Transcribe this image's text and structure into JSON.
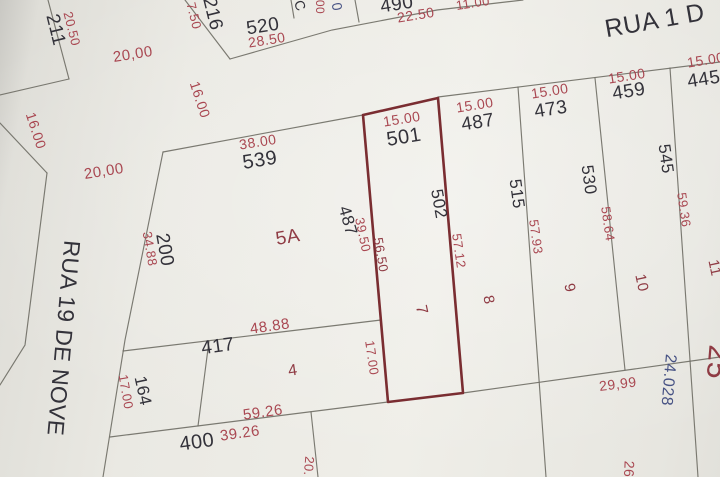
{
  "title": "cadastral plat map photo",
  "palette": {
    "line": "#6e6d64",
    "maroon": "#7a2d31",
    "black": "#33323a",
    "red": "#a94751",
    "lotred": "#8f3b44",
    "navy": "#475284"
  },
  "map": {
    "highlight_parcel": {
      "id": "highlighted-parcel-501-502",
      "points": "363,115 438,98 463,393 388,402",
      "stroke": "maroon",
      "w": 2.6
    },
    "lines": [
      {
        "id": "lot-211-east-boundary",
        "points": "48,0 69,79"
      },
      {
        "id": "lot-211-south-boundary",
        "points": "69,79 0,95"
      },
      {
        "id": "street-corner-boundary",
        "points": "47,173 0,123"
      },
      {
        "id": "rua19-west-edge",
        "points": "47,173 25,345 0,385"
      },
      {
        "id": "block-216-west-boundary",
        "points": "185,0 230,59"
      },
      {
        "id": "block-216-south-boundary",
        "points": "230,59 332,30 437,10 523,0"
      },
      {
        "id": "divider-520-partial-lot",
        "points": "291,0 294,18"
      },
      {
        "id": "divider-partial-lot-490",
        "points": "355,0 359,22"
      },
      {
        "id": "rua1-block-north-boundary",
        "points": "438,97 720,62"
      },
      {
        "id": "block-539-north-boundary",
        "points": "163,152 363,115"
      },
      {
        "id": "block-539-west-boundary",
        "points": "163,152 125,340 103,477"
      },
      {
        "id": "lot-417-north-boundary",
        "points": "123,351 381,320"
      },
      {
        "id": "divider-164-417",
        "points": "209,341 198,426"
      },
      {
        "id": "lot-417-south-boundary",
        "points": "110,437 388,402"
      },
      {
        "id": "lot-400-east-divider",
        "points": "311,412 318,477"
      },
      {
        "id": "diagonal-rear-boundary",
        "points": "463,393 720,357"
      },
      {
        "id": "divider-strip-8-9",
        "points": "518,87 546,477"
      },
      {
        "id": "divider-strip-9-10",
        "points": "595,78 625,370"
      },
      {
        "id": "divider-strip-10-11",
        "points": "670,68 698,477"
      }
    ],
    "labels": [
      {
        "id": "lot-label-211",
        "text": "211",
        "x": 55,
        "y": 30,
        "rot": 76,
        "color": "black",
        "size": 19
      },
      {
        "id": "dim-label-20-50",
        "text": "20.50",
        "x": 71,
        "y": 29,
        "rot": 76,
        "color": "red",
        "size": 13
      },
      {
        "id": "dim-label-16-00-left",
        "text": "16.00",
        "x": 35,
        "y": 131,
        "rot": 72,
        "color": "red",
        "size": 14
      },
      {
        "id": "dim-label-20-00-top",
        "text": "20,00",
        "x": 133,
        "y": 55,
        "rot": -9,
        "color": "red",
        "size": 15
      },
      {
        "id": "dim-label-20-00-mid",
        "text": "20,00",
        "x": 104,
        "y": 172,
        "rot": -9,
        "color": "red",
        "size": 15
      },
      {
        "id": "dim-label-16-00-right",
        "text": "16.00",
        "x": 199,
        "y": 100,
        "rot": 72,
        "color": "red",
        "size": 14
      },
      {
        "id": "dim-label-7-50",
        "text": "7.50",
        "x": 193,
        "y": 16,
        "rot": 76,
        "color": "red",
        "size": 13
      },
      {
        "id": "lot-label-216",
        "text": "216",
        "x": 212,
        "y": 14,
        "rot": 76,
        "color": "black",
        "size": 19
      },
      {
        "id": "lot-label-520",
        "text": "520",
        "x": 263,
        "y": 27,
        "rot": -9,
        "color": "black",
        "size": 19
      },
      {
        "id": "dim-label-28-50",
        "text": "28.50",
        "x": 267,
        "y": 41,
        "rot": -9,
        "color": "red",
        "size": 14
      },
      {
        "id": "partial-label-c",
        "text": "C",
        "x": 299,
        "y": 6,
        "rot": 70,
        "color": "black",
        "size": 14
      },
      {
        "id": "partial-dim-00",
        "text": "00",
        "x": 319,
        "y": 7,
        "rot": 90,
        "color": "red",
        "size": 12
      },
      {
        "id": "partial-label-0",
        "text": "0",
        "x": 336,
        "y": 7,
        "rot": 80,
        "color": "navy",
        "size": 14
      },
      {
        "id": "lot-label-490",
        "text": "490",
        "x": 397,
        "y": 5,
        "rot": -9,
        "color": "black",
        "size": 19
      },
      {
        "id": "dim-label-22-50",
        "text": "22.50",
        "x": 416,
        "y": 16,
        "rot": -9,
        "color": "red",
        "size": 14
      },
      {
        "id": "dim-label-11-00",
        "text": "11.00",
        "x": 473,
        "y": 4,
        "rot": -9,
        "color": "red",
        "size": 13
      },
      {
        "id": "street-label-rua-1",
        "text": "RUA 1 D",
        "x": 655,
        "y": 22,
        "rot": -10,
        "color": "black",
        "size": 25,
        "ls": 6
      },
      {
        "id": "dim-label-15-00-487",
        "text": "15.00",
        "x": 475,
        "y": 106,
        "rot": -9,
        "color": "red",
        "size": 14
      },
      {
        "id": "lot-label-487",
        "text": "487",
        "x": 478,
        "y": 123,
        "rot": -9,
        "color": "black",
        "size": 19
      },
      {
        "id": "dim-label-15-00-473",
        "text": "15.00",
        "x": 550,
        "y": 92,
        "rot": -9,
        "color": "red",
        "size": 14
      },
      {
        "id": "lot-label-473",
        "text": "473",
        "x": 551,
        "y": 110,
        "rot": -9,
        "color": "black",
        "size": 19
      },
      {
        "id": "dim-label-15-00-459",
        "text": "15.00",
        "x": 627,
        "y": 77,
        "rot": -9,
        "color": "red",
        "size": 14
      },
      {
        "id": "lot-label-459",
        "text": "459",
        "x": 629,
        "y": 92,
        "rot": -9,
        "color": "black",
        "size": 19
      },
      {
        "id": "dim-label-15-00-445",
        "text": "15.00",
        "x": 706,
        "y": 61,
        "rot": -9,
        "color": "red",
        "size": 14
      },
      {
        "id": "lot-label-445",
        "text": "445",
        "x": 704,
        "y": 80,
        "rot": -9,
        "color": "black",
        "size": 19
      },
      {
        "id": "dim-label-38-00",
        "text": "38.00",
        "x": 258,
        "y": 143,
        "rot": -9,
        "color": "red",
        "size": 14
      },
      {
        "id": "lot-label-539",
        "text": "539",
        "x": 260,
        "y": 161,
        "rot": -9,
        "color": "black",
        "size": 20
      },
      {
        "id": "dim-label-15-00-501",
        "text": "15.00",
        "x": 402,
        "y": 120,
        "rot": -9,
        "color": "red",
        "size": 14
      },
      {
        "id": "lot-label-501",
        "text": "501",
        "x": 404,
        "y": 138,
        "rot": -9,
        "color": "black",
        "size": 20
      },
      {
        "id": "dim-label-34-88",
        "text": "34.88",
        "x": 149,
        "y": 249,
        "rot": 80,
        "color": "red",
        "size": 13
      },
      {
        "id": "lot-label-200",
        "text": "200",
        "x": 164,
        "y": 250,
        "rot": 80,
        "color": "black",
        "size": 19
      },
      {
        "id": "lot-label-5a",
        "text": "5A",
        "x": 288,
        "y": 238,
        "rot": -10,
        "color": "lotred",
        "size": 19
      },
      {
        "id": "lot-label-487-side",
        "text": "487",
        "x": 347,
        "y": 221,
        "rot": 74,
        "color": "black",
        "size": 17
      },
      {
        "id": "dim-label-39-50",
        "text": "39.50",
        "x": 362,
        "y": 235,
        "rot": 78,
        "color": "red",
        "size": 13
      },
      {
        "id": "dim-label-56-50",
        "text": "56.50",
        "x": 380,
        "y": 255,
        "rot": 80,
        "color": "lotred",
        "size": 13
      },
      {
        "id": "lot-label-502",
        "text": "502",
        "x": 438,
        "y": 204,
        "rot": 80,
        "color": "black",
        "size": 17
      },
      {
        "id": "dim-label-57-12",
        "text": "57.12",
        "x": 458,
        "y": 251,
        "rot": 82,
        "color": "red",
        "size": 13
      },
      {
        "id": "lot-label-515",
        "text": "515",
        "x": 516,
        "y": 194,
        "rot": 82,
        "color": "black",
        "size": 17
      },
      {
        "id": "dim-label-57-93",
        "text": "57.93",
        "x": 535,
        "y": 237,
        "rot": 82,
        "color": "red",
        "size": 13
      },
      {
        "id": "lot-label-530",
        "text": "530",
        "x": 588,
        "y": 180,
        "rot": 82,
        "color": "black",
        "size": 17
      },
      {
        "id": "dim-label-58-64",
        "text": "58.64",
        "x": 607,
        "y": 224,
        "rot": 82,
        "color": "red",
        "size": 13
      },
      {
        "id": "lot-label-545",
        "text": "545",
        "x": 665,
        "y": 159,
        "rot": 82,
        "color": "black",
        "size": 17
      },
      {
        "id": "dim-label-59-36",
        "text": "59.36",
        "x": 683,
        "y": 210,
        "rot": 82,
        "color": "red",
        "size": 13
      },
      {
        "id": "lot-label-7",
        "text": "7",
        "x": 421,
        "y": 310,
        "rot": 78,
        "color": "lotred",
        "size": 16
      },
      {
        "id": "lot-label-8",
        "text": "8",
        "x": 488,
        "y": 300,
        "rot": 78,
        "color": "lotred",
        "size": 15
      },
      {
        "id": "lot-label-9",
        "text": "9",
        "x": 569,
        "y": 288,
        "rot": 78,
        "color": "lotred",
        "size": 15
      },
      {
        "id": "lot-label-10",
        "text": "10",
        "x": 641,
        "y": 283,
        "rot": 78,
        "color": "lotred",
        "size": 15
      },
      {
        "id": "lot-label-11",
        "text": "11",
        "x": 714,
        "y": 268,
        "rot": 78,
        "color": "lotred",
        "size": 15
      },
      {
        "id": "street-label-rua-19",
        "text": "RUA 19 DE NOVE",
        "x": 62,
        "y": 338,
        "rot": 95,
        "color": "black",
        "size": 23,
        "ls": 5
      },
      {
        "id": "dim-label-48-88",
        "text": "48.88",
        "x": 270,
        "y": 327,
        "rot": -8,
        "color": "red",
        "size": 15
      },
      {
        "id": "lot-label-417",
        "text": "417",
        "x": 218,
        "y": 347,
        "rot": -8,
        "color": "black",
        "size": 19
      },
      {
        "id": "lot-label-4",
        "text": "4",
        "x": 293,
        "y": 371,
        "rot": -8,
        "color": "lotred",
        "size": 16
      },
      {
        "id": "dim-label-17-00-strip",
        "text": "17.00",
        "x": 371,
        "y": 358,
        "rot": 82,
        "color": "red",
        "size": 13
      },
      {
        "id": "lot-label-164",
        "text": "164",
        "x": 142,
        "y": 391,
        "rot": 78,
        "color": "black",
        "size": 17
      },
      {
        "id": "dim-label-17-00-164",
        "text": "17.00",
        "x": 125,
        "y": 392,
        "rot": 80,
        "color": "red",
        "size": 13
      },
      {
        "id": "dim-label-59-26",
        "text": "59.26",
        "x": 263,
        "y": 413,
        "rot": -8,
        "color": "red",
        "size": 15
      },
      {
        "id": "dim-label-39-26",
        "text": "39.26",
        "x": 240,
        "y": 434,
        "rot": -8,
        "color": "red",
        "size": 15
      },
      {
        "id": "lot-label-400",
        "text": "400",
        "x": 197,
        "y": 443,
        "rot": -8,
        "color": "black",
        "size": 20
      },
      {
        "id": "dim-label-20-bottom",
        "text": "20.",
        "x": 308,
        "y": 466,
        "rot": 95,
        "color": "red",
        "size": 13
      },
      {
        "id": "dim-label-29-99",
        "text": "29,99",
        "x": 618,
        "y": 385,
        "rot": -7,
        "color": "red",
        "size": 14
      },
      {
        "id": "dim-label-24-028",
        "text": "24.028",
        "x": 668,
        "y": 380,
        "rot": 95,
        "color": "navy",
        "size": 16
      },
      {
        "id": "dim-label-26-partial",
        "text": "26",
        "x": 628,
        "y": 469,
        "rot": 92,
        "color": "red",
        "size": 14
      },
      {
        "id": "lot-label-25-partial",
        "text": "25",
        "x": 716,
        "y": 362,
        "rot": 95,
        "color": "lotred",
        "size": 30
      }
    ]
  }
}
